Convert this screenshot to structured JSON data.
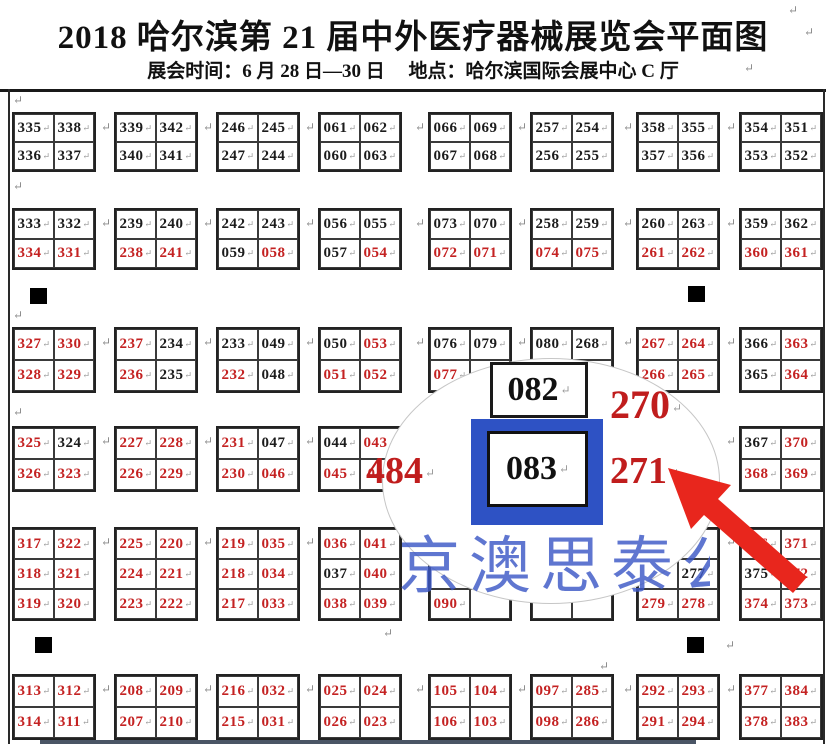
{
  "header": {
    "title": "2018 哈尔滨第 21 届中外医疗器械展览会平面图",
    "subtitle": "展会时间：6 月 28 日—30 日　 地点：哈尔滨国际会展中心  C 厅"
  },
  "colors": {
    "booth_black": "#1c1c1c",
    "booth_red": "#c42222",
    "highlight_blue": "#2e52c4",
    "watermark_blue": "#3c58c6",
    "arrow_red": "#e8261d"
  },
  "map": {
    "red_marker_prefix": "*",
    "block_lefts": [
      12,
      114,
      216,
      318,
      428,
      530,
      636,
      739
    ],
    "block_width": 84,
    "rows": [
      {
        "top": 112,
        "cell_h": 28,
        "blocks": [
          [
            [
              "335",
              "338"
            ],
            [
              "336",
              "337"
            ]
          ],
          [
            [
              "339",
              "342"
            ],
            [
              "340",
              "341"
            ]
          ],
          [
            [
              "246",
              "245"
            ],
            [
              "247",
              "244"
            ]
          ],
          [
            [
              "061",
              "062"
            ],
            [
              "060",
              "063"
            ]
          ],
          [
            [
              "066",
              "069"
            ],
            [
              "067",
              "068"
            ]
          ],
          [
            [
              "257",
              "254"
            ],
            [
              "256",
              "255"
            ]
          ],
          [
            [
              "358",
              "355"
            ],
            [
              "357",
              "356"
            ]
          ],
          [
            [
              "354",
              "351"
            ],
            [
              "353",
              "352"
            ]
          ]
        ]
      },
      {
        "top": 208,
        "cell_h": 29,
        "blocks": [
          [
            [
              "333",
              "332"
            ],
            [
              "*334",
              "*331"
            ]
          ],
          [
            [
              "239",
              "240"
            ],
            [
              "*238",
              "*241"
            ]
          ],
          [
            [
              "242",
              "243"
            ],
            [
              "059",
              "*058"
            ]
          ],
          [
            [
              "056",
              "055"
            ],
            [
              "057",
              "*054"
            ]
          ],
          [
            [
              "073",
              "070"
            ],
            [
              "*072",
              "*071"
            ]
          ],
          [
            [
              "258",
              "259"
            ],
            [
              "*074",
              "*075"
            ]
          ],
          [
            [
              "260",
              "263"
            ],
            [
              "*261",
              "*262"
            ]
          ],
          [
            [
              "359",
              "362"
            ],
            [
              "*360",
              "*361"
            ]
          ]
        ]
      },
      {
        "top": 327,
        "cell_h": 31,
        "blocks": [
          [
            [
              "*327",
              "*330"
            ],
            [
              "*328",
              "*329"
            ]
          ],
          [
            [
              "*237",
              "234"
            ],
            [
              "*236",
              "235"
            ]
          ],
          [
            [
              "233",
              "049"
            ],
            [
              "*232",
              "048"
            ]
          ],
          [
            [
              "050",
              "*053"
            ],
            [
              "*051",
              "*052"
            ]
          ],
          [
            [
              "076",
              "079"
            ],
            [
              "*077",
              ""
            ]
          ],
          [
            [
              "080",
              "268"
            ],
            [
              "",
              ""
            ]
          ],
          [
            [
              "*267",
              "*264"
            ],
            [
              "*266",
              "*265"
            ]
          ],
          [
            [
              "366",
              "*363"
            ],
            [
              "365",
              "*364"
            ]
          ]
        ]
      },
      {
        "top": 426,
        "cell_h": 31,
        "blocks": [
          [
            [
              "*325",
              "324"
            ],
            [
              "*326",
              "*323"
            ]
          ],
          [
            [
              "*227",
              "*228"
            ],
            [
              "*226",
              "*229"
            ]
          ],
          [
            [
              "*231",
              "047"
            ],
            [
              "*230",
              "*046"
            ]
          ],
          [
            [
              "044",
              "*043"
            ],
            [
              "*045",
              "*04"
            ]
          ],
          null,
          null,
          null,
          [
            [
              "367",
              "*370"
            ],
            [
              "*368",
              "*369"
            ]
          ]
        ]
      },
      {
        "top": 527,
        "cell_h": 30,
        "blocks": [
          [
            [
              "*317",
              "*322"
            ],
            [
              "*318",
              "*321"
            ],
            [
              "*319",
              "*320"
            ]
          ],
          [
            [
              "*225",
              "*220"
            ],
            [
              "*224",
              "*221"
            ],
            [
              "*223",
              "*222"
            ]
          ],
          [
            [
              "*219",
              "*035"
            ],
            [
              "*218",
              "*034"
            ],
            [
              "*217",
              "*033"
            ]
          ],
          [
            [
              "*036",
              "*041"
            ],
            [
              "037",
              "*040"
            ],
            [
              "*038",
              "*039"
            ]
          ],
          [
            [
              "",
              ""
            ],
            [
              "",
              ""
            ],
            [
              "*090",
              ""
            ]
          ],
          [
            [
              "",
              ""
            ],
            [
              "",
              ""
            ],
            [
              "",
              ""
            ]
          ],
          [
            [
              "",
              ""
            ],
            [
              "",
              "277"
            ],
            [
              "*279",
              "*278"
            ]
          ],
          [
            [
              "*376",
              "*371"
            ],
            [
              "375",
              "*372"
            ],
            [
              "*374",
              "*373"
            ]
          ]
        ]
      },
      {
        "top": 674,
        "cell_h": 31,
        "blocks": [
          [
            [
              "*313",
              "*312"
            ],
            [
              "*314",
              "*311"
            ]
          ],
          [
            [
              "*208",
              "*209"
            ],
            [
              "*207",
              "*210"
            ]
          ],
          [
            [
              "*216",
              "*032"
            ],
            [
              "*215",
              "*031"
            ]
          ],
          [
            [
              "*025",
              "*024"
            ],
            [
              "*026",
              "*023"
            ]
          ],
          [
            [
              "*105",
              "*104"
            ],
            [
              "*106",
              "*103"
            ]
          ],
          [
            [
              "*097",
              "*285"
            ],
            [
              "*098",
              "*286"
            ]
          ],
          [
            [
              "*292",
              "*293"
            ],
            [
              "*291",
              "*294"
            ]
          ],
          [
            [
              "*377",
              "*384"
            ],
            [
              "*378",
              "*383"
            ]
          ]
        ]
      }
    ],
    "squares": [
      {
        "x": 30,
        "y": 288
      },
      {
        "x": 688,
        "y": 286
      },
      {
        "x": 35,
        "y": 637
      },
      {
        "x": 687,
        "y": 637
      }
    ],
    "loose_marks": [
      [
        788,
        4
      ],
      [
        804,
        26
      ],
      [
        744,
        62
      ],
      [
        13,
        94
      ],
      [
        13,
        180
      ],
      [
        13,
        309
      ],
      [
        13,
        406
      ],
      [
        383,
        627
      ],
      [
        599,
        660
      ],
      [
        725,
        639
      ]
    ]
  },
  "magnifier": {
    "booth_top": "082",
    "booth_main": "083",
    "booth_right_top": "270",
    "booth_right_bottom": "271",
    "booth_left_partial": "484"
  },
  "watermark": {
    "text": "京澳思泰公"
  }
}
